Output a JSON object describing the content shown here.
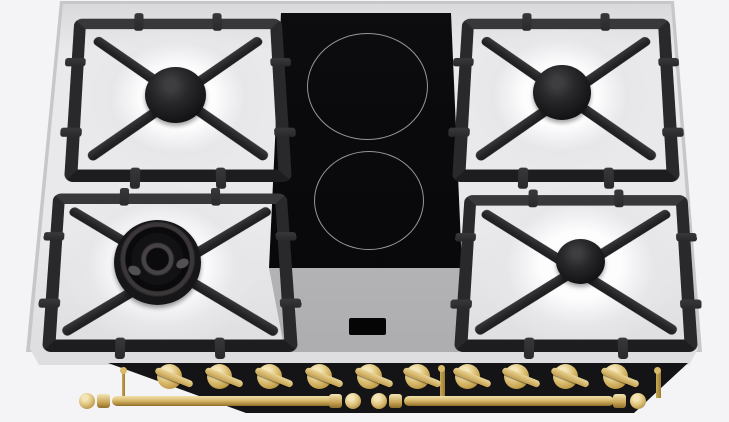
{
  "scene": {
    "title": "Dual-fuel range cooktop, front-top view",
    "description": "Render of a 90 cm dual-fuel range top: four gas burners on black cast-iron grates over a stainless-steel surface flanking a central two-zone black ceramic glass panel, with a gray control module, black front fascia, ten brass control knobs and a brass towel rail."
  },
  "components": {
    "gas_burners": 4,
    "induction_zones": 2,
    "control_knobs": 10,
    "grates": 4,
    "rail_segments": 2,
    "burner_rear_left": "rear-left gas burner",
    "burner_front_left": "front-left wok burner",
    "burner_rear_right": "rear-right gas burner",
    "burner_front_right": "front-right gas burner",
    "zone_rear": "rear ceramic cooking zone",
    "zone_front": "front ceramic cooking zone",
    "knob_title": "brass control knob",
    "rail_title": "brass towel rail",
    "display_state": "off"
  },
  "colors": {
    "background": "#f4f4f6",
    "steel_rim": "#c7c7c9",
    "steel_light": "#e9e9eb",
    "steel_mid": "#d8d8da",
    "well_white": "#fdfdfe",
    "iron": "#29292b",
    "iron_deep": "#1d1d1f",
    "iron_hi": "#38383a",
    "glass": "#0a0a0c",
    "ring": "#969698",
    "panel_light": "#d5d5d7",
    "panel_mid": "#b1b1b3",
    "band": "#141416",
    "brass_light": "#f3e5b6",
    "brass_mid": "#d9ba6b",
    "brass_dark": "#8a6a28",
    "display": "#050505"
  }
}
